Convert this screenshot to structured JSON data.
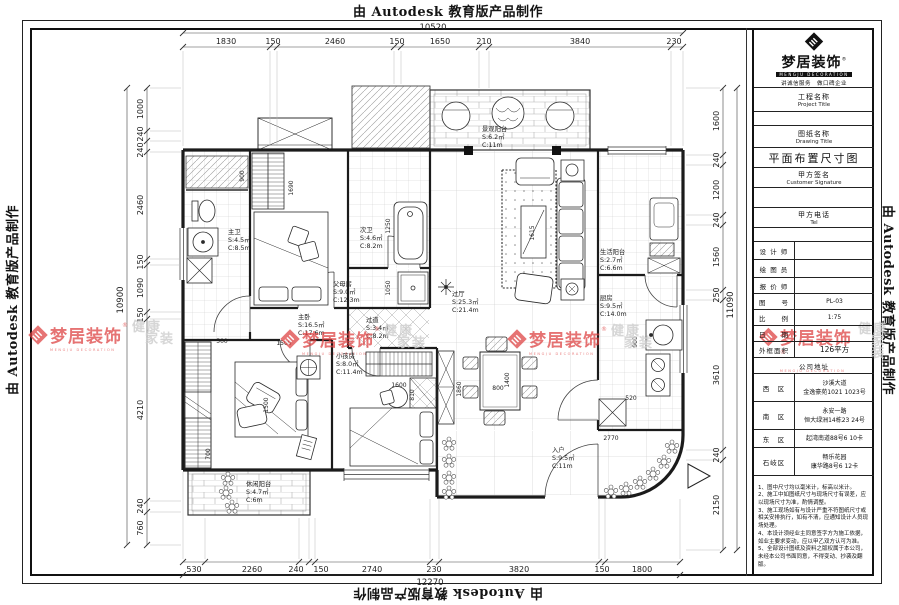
{
  "watermarks": {
    "autodesk": "由 Autodesk 教育版产品制作",
    "brand": {
      "cn": "梦居装饰",
      "reg": "®",
      "en": "MENGJU DECORATION",
      "gray1": "健康",
      "gray2": "家装"
    }
  },
  "title_block": {
    "logo": {
      "cn": "梦居装饰",
      "reg": "®",
      "en": "MENGJU DECORATION",
      "slogan": "讲诚信服务　做口碑企业"
    },
    "project_label_cn": "工程名称",
    "project_label_en": "Project Title",
    "drawing_label_cn": "图纸名称",
    "drawing_label_en": "Drawing Title",
    "drawing_title": "平面布置尺寸图",
    "signature_label_cn": "甲方签名",
    "signature_label_en": "Customer Signature",
    "tel_label_cn": "甲方电话",
    "tel_label_en": "Tel",
    "designer_label": "设 计 师",
    "draftsman_label": "绘 图 员",
    "estimator_label": "报 价 师",
    "drawing_no_label": "图　　号",
    "drawing_no": "PL-03",
    "scale_label": "比　　例",
    "scale": "1:75",
    "date_label": "日　　期",
    "date": "",
    "area_label": "外框面积",
    "area": "126平方",
    "address_header": "公司地址",
    "addresses": [
      {
        "district": "西　区",
        "line1": "沙溪大道",
        "line2": "金逸豪苑1021 1023号"
      },
      {
        "district": "南　区",
        "line1": "永安一路",
        "line2": "恒大绿洲14栋23 24号"
      },
      {
        "district": "东　区",
        "line1": "起湾南道88号6 10卡",
        "line2": ""
      },
      {
        "district": "石岐区",
        "line1": "畅乐花园",
        "line2": "康华路8号6 12卡"
      }
    ],
    "notes": [
      "1、图中尺寸均以毫米计，标高以米计。",
      "2、施工中如图纸尺寸与现场尺寸有误差，应以现场尺寸为准，酌情调整。",
      "3、施工现场如有与设计严重不符图纸尺寸或相关安排执行，如有不清，应通知设计人员现场处理。",
      "4、本设计须经业主同意签字方为施工依据，如业主要求变动，应以甲乙双方认可为准。",
      "5、全部设计图纸及资料之版权属于本公司，未经本公司书面同意，不得变动、抄袭及翻版。"
    ]
  },
  "plan": {
    "rooms": {
      "master_bath": {
        "name": "主卫",
        "s": "S:4.5㎡",
        "c": "C:8.5m"
      },
      "parents_room": {
        "name": "父母房",
        "s": "S:9.0㎡",
        "c": "C:12.3m"
      },
      "second_bath": {
        "name": "次卫",
        "s": "S:4.6㎡",
        "c": "C:8.2m"
      },
      "view_balcony": {
        "name": "景观阳台",
        "s": "S:6.2㎡",
        "c": "C:11m"
      },
      "hall": {
        "name": "过厅",
        "s": "S:25.3㎡",
        "c": "C:21.4m"
      },
      "service_balcony": {
        "name": "生活阳台",
        "s": "S:2.7㎡",
        "c": "C:6.6m"
      },
      "kitchen": {
        "name": "厨房",
        "s": "S:9.5㎡",
        "c": "C:14.0m"
      },
      "entry": {
        "name": "入户",
        "s": "S:9.5㎡",
        "c": "C:11m"
      },
      "master_bedroom": {
        "name": "主卧",
        "s": "S:16.5㎡",
        "c": "C:17.6m"
      },
      "kids_room": {
        "name": "小孩房",
        "s": "S:8.0㎡",
        "c": "C:11.4m"
      },
      "passage": {
        "name": "过道",
        "s": "S:3.4㎡",
        "c": "C:8.2m"
      },
      "leisure_balcony": {
        "name": "休闲阳台",
        "s": "S:4.7㎡",
        "c": "C:6m"
      }
    },
    "dims": {
      "top": {
        "total": "10520",
        "values": [
          "1830",
          "150",
          "2460",
          "150",
          "1650",
          "210",
          "3840",
          "230"
        ]
      },
      "bottom": {
        "total": "12270",
        "values": [
          "530",
          "2260",
          "240",
          "150",
          "2740",
          "230",
          "3820",
          "150",
          "1800"
        ]
      },
      "left": {
        "total": "10900",
        "values": [
          "1000",
          "240",
          "240",
          "2460",
          "150",
          "1090",
          "150",
          "4210",
          "240",
          "760"
        ]
      },
      "right": {
        "total": "11090",
        "values": [
          "1600",
          "240",
          "1200",
          "240",
          "1560",
          "250",
          "3610",
          "240",
          "2150"
        ]
      },
      "inner": [
        "900",
        "1690",
        "1500",
        "1250",
        "1050",
        "1615",
        "1600",
        "810",
        "1860",
        "1400",
        "800",
        "900",
        "520",
        "2770",
        "1500",
        "500",
        "700"
      ]
    }
  }
}
